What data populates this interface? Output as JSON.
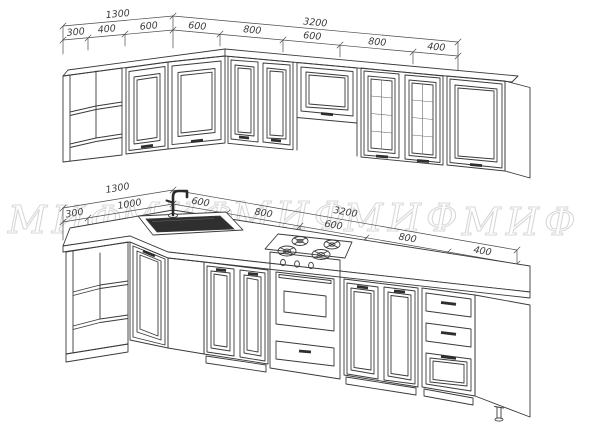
{
  "watermark": {
    "text": "МИФ"
  },
  "upper_row": {
    "total_dims": [
      "1300",
      "3200"
    ],
    "segment_dims": [
      "300",
      "400",
      "600",
      "600",
      "800",
      "600",
      "800",
      "400"
    ]
  },
  "lower_row": {
    "total_dims": [
      "1300",
      "3200"
    ],
    "segment_dims": [
      "300",
      "1000",
      "600",
      "800",
      "600",
      "800",
      "400"
    ]
  },
  "palette": {
    "line": "#3a3a3a",
    "dim_line": "#4a4a4a",
    "watermark": "#d8d8d8",
    "sink": "#2f2f2f",
    "handle": "#2e2e2e"
  }
}
